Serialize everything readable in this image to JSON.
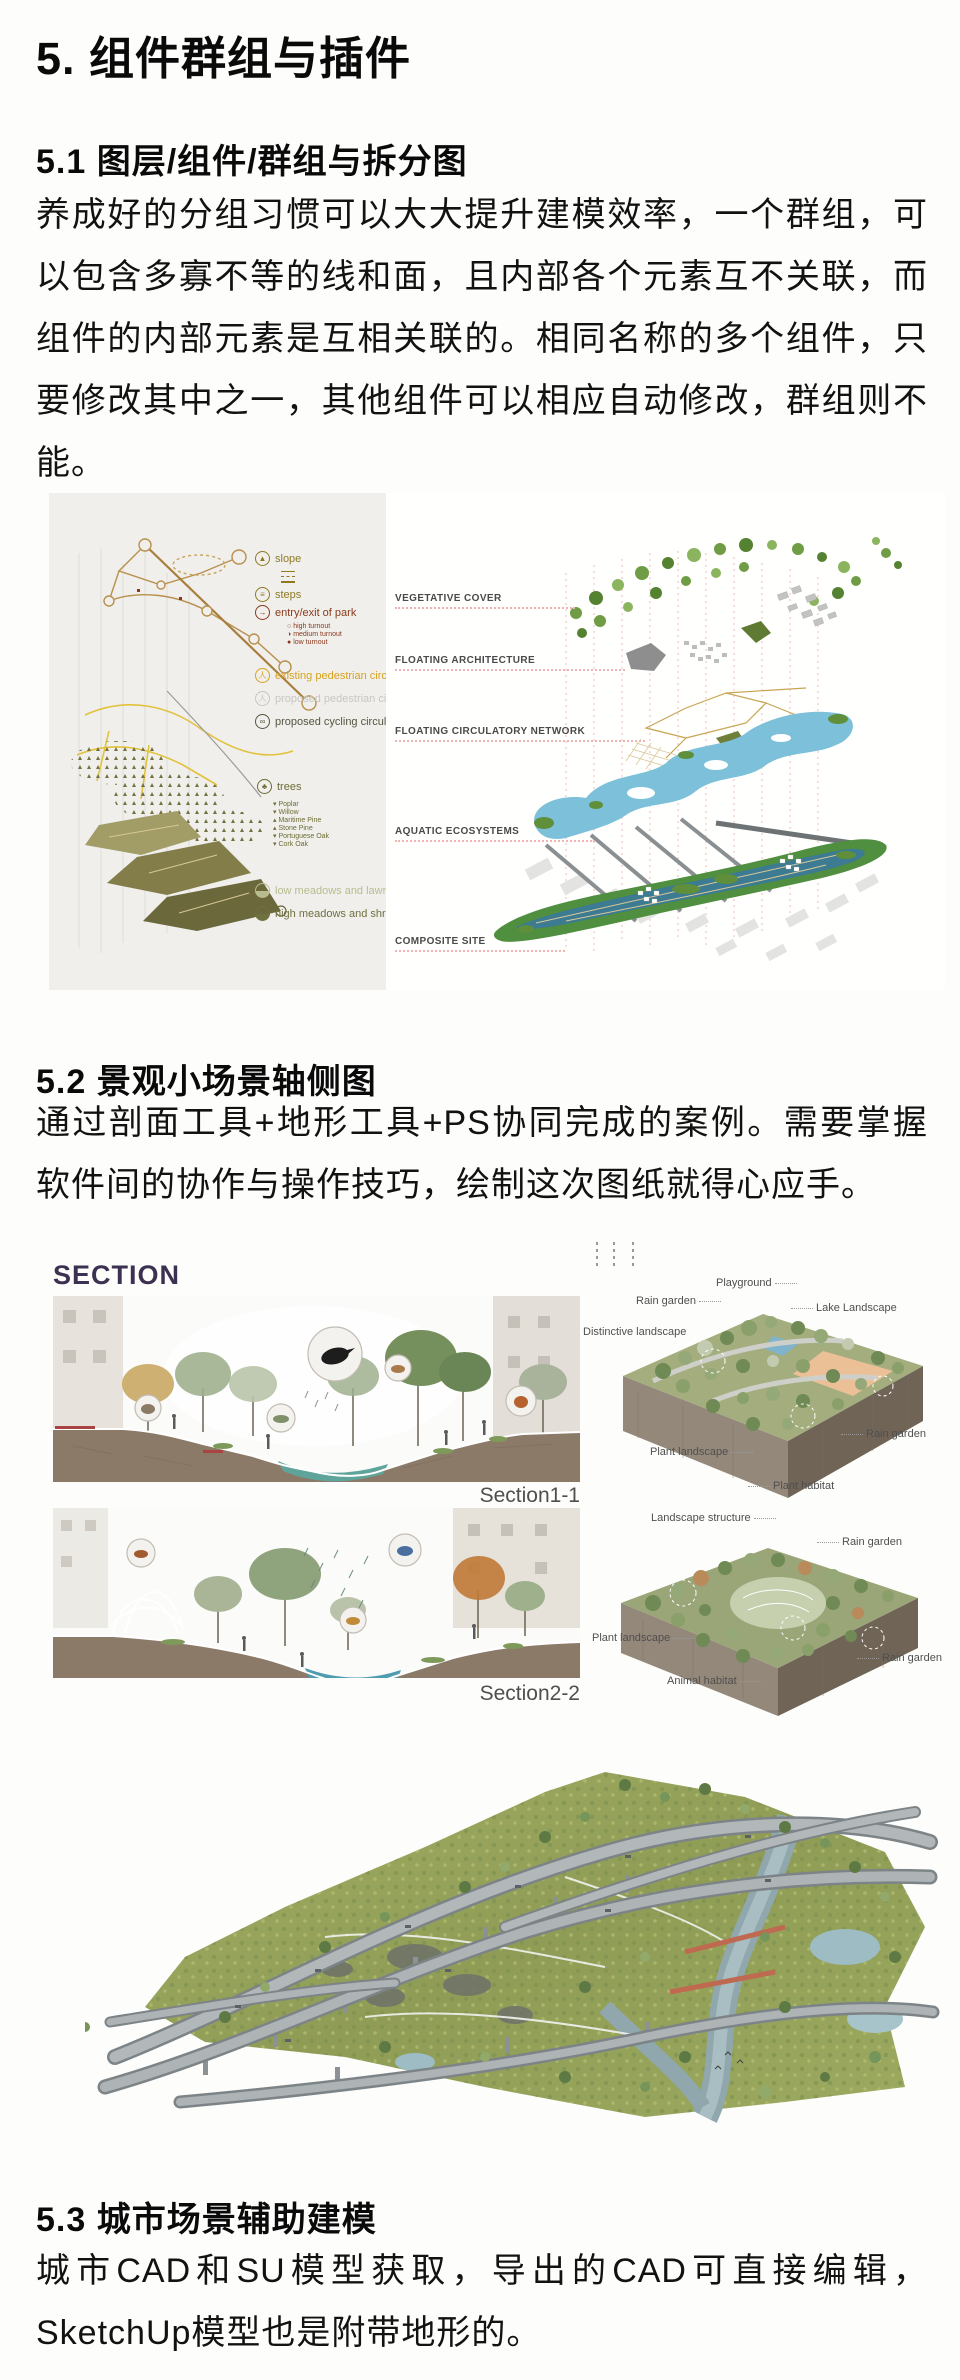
{
  "article": {
    "h1": "5. 组件群组与插件",
    "s51_title": "5.1 图层/组件/群组与拆分图",
    "s51_body": "养成好的分组习惯可以大大提升建模效率，一个群组，可以包含多寡不等的线和面，且内部各个元素互不关联，而组件的内部元素是互相关联的。相同名称的多个组件，只要修改其中之一，其他组件可以相应自动修改，群组则不能。",
    "s52_title": "5.2 景观小场景轴侧图",
    "s52_body": "通过剖面工具+地形工具+PS协同完成的案例。需要掌握软件间的协作与操作技巧，绘制这次图纸就得心应手。",
    "s53_title": "5.3 城市场景辅助建模",
    "s53_body": "城市CAD和SU模型获取，导出的CAD可直接编辑，SketchUp模型也是附带地形的。"
  },
  "figure1": {
    "legend": {
      "slope": "slope",
      "steps": "steps",
      "entry_exit": "entry/exit of park",
      "turnouts": [
        "high turnout",
        "medium turnout",
        "low turnout"
      ],
      "existing_pedestrian": "existing pedestrian circulation",
      "proposed_pedestrian": "proposed pedestrian circulation",
      "proposed_cycling": "proposed cycling circulation",
      "trees": "trees",
      "tree_species": [
        "Poplar",
        "Willow",
        "Maritime Pine",
        "Stone Pine",
        "Portuguese Oak",
        "Cork Oak"
      ],
      "low_meadows": "low meadows and lawns",
      "high_meadows": "high meadows and shrubs"
    },
    "layer_labels": [
      "VEGETATIVE COVER",
      "FLOATING ARCHITECTURE",
      "FLOATING CIRCULATORY NETWORK",
      "AQUATIC ECOSYSTEMS",
      "COMPOSITE SITE"
    ]
  },
  "figure2": {
    "title": "SECTION",
    "caption1": "Section1-1",
    "caption2": "Section2-2",
    "block1": {
      "playground": "Playground",
      "rain_garden_top": "Rain garden",
      "lake_landscape": "Lake Landscape",
      "distinctive_landscape": "Distinctive landscape",
      "rain_garden_right": "Rain garden",
      "plant_landscape": "Plant landscape",
      "plant_habitat": "Plant habitat"
    },
    "block2": {
      "landscape_structure": "Landscape structure",
      "rain_garden_top": "Rain garden",
      "plant_landscape": "Plant landscape",
      "rain_garden_right": "Rain garden",
      "animal_habitat": "Animal habitat"
    }
  },
  "colors": {
    "leader_dotted_red": "#eeb3b3",
    "section_title": "#3c3150",
    "legend_gold": "#d6a31f",
    "legend_rust": "#8a3a1c",
    "soil_brown": "#8c7a69",
    "water_teal": "#5fa49b",
    "water_blue": "#7cc0da"
  }
}
